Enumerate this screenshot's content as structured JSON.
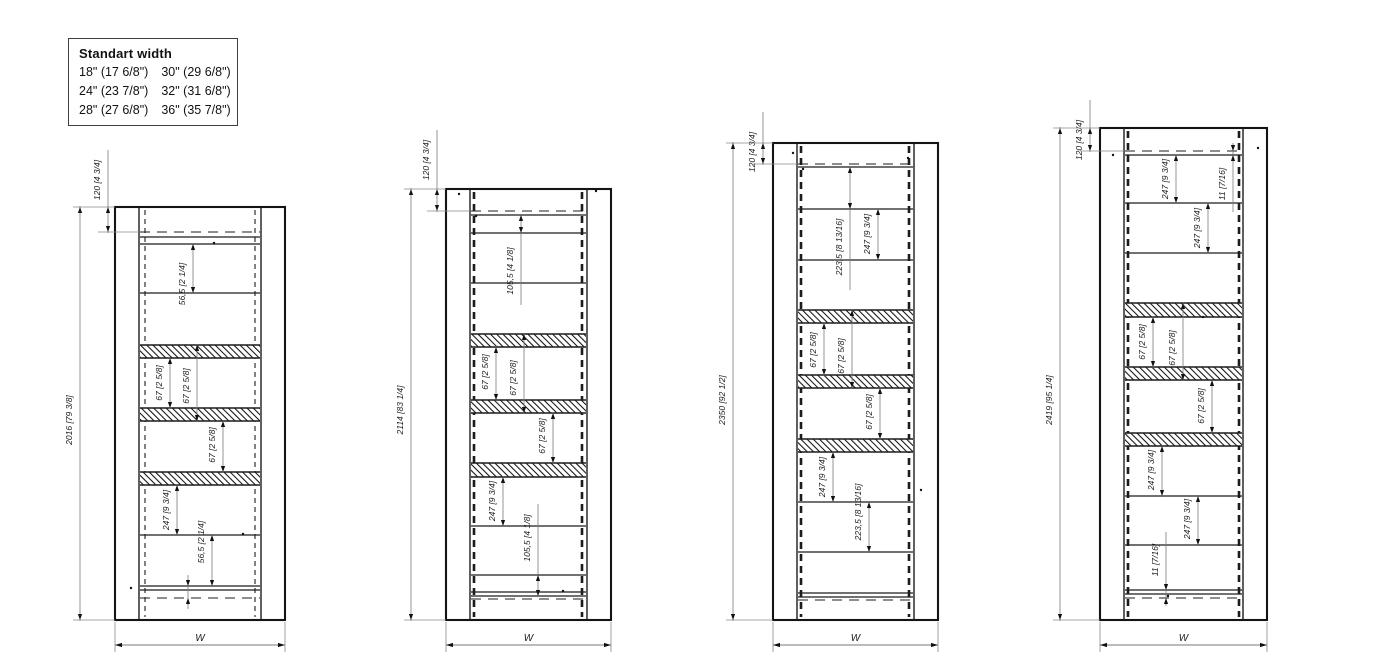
{
  "legend": {
    "title": "Standart width",
    "items": [
      "18\" (17 6/8\")",
      "24\" (23 7/8\")",
      "28\" (27 6/8\")",
      "30\" (29 6/8\")",
      "32\" (31 6/8\")",
      "36\" (35 7/8\")"
    ]
  },
  "drawing": {
    "colors": {
      "frame": "#141414",
      "line": "#1c1c1c",
      "hidden": "#1c1c1c",
      "dim_line": "#7a7a7a",
      "dim_text": "#1c1c1c",
      "arrow": "#111111"
    },
    "cabinets": [
      {
        "id": "elevation-2016",
        "outer": [
          115,
          207,
          170,
          413
        ],
        "wall": 24,
        "dash_x": [
          145,
          255
        ],
        "dash_style": "thin",
        "hlines": [
          [
            232,
            "d"
          ],
          [
            237,
            "s"
          ],
          [
            244,
            "s"
          ],
          [
            293,
            "s"
          ],
          [
            535,
            "s"
          ],
          [
            586,
            "s"
          ],
          [
            590,
            "s"
          ],
          [
            598,
            "d"
          ]
        ],
        "bands": [
          [
            345,
            358
          ],
          [
            408,
            421
          ],
          [
            472,
            485
          ]
        ],
        "vdims": [
          {
            "t": "120 [4 3/4]",
            "x": 108,
            "y1": 207,
            "y2": 232,
            "tx": 100,
            "ty": 180,
            "ly1": 150,
            "ext": [
              98,
              232,
              139
            ]
          },
          {
            "t": "2016 [79 3/8]",
            "x": 80,
            "y1": 207,
            "y2": 620,
            "tx": 72,
            "ty": 420,
            "cap": 1
          },
          {
            "t": "56,5 [2 1/4]",
            "x": 193,
            "y1": 244,
            "y2": 293,
            "tx": 185,
            "ty": 284
          },
          {
            "t": "67 [2 5/8]",
            "x": 170,
            "y1": 358,
            "y2": 408,
            "tx": 162,
            "ty": 383
          },
          {
            "t": "67 [2 5/8]",
            "x": 197,
            "y1": 345,
            "y2": 421,
            "tx": 189,
            "ty": 386
          },
          {
            "t": "67 [2 5/8]",
            "x": 223,
            "y1": 421,
            "y2": 472,
            "tx": 215,
            "ty": 445
          },
          {
            "t": "247 [9 3/4]",
            "x": 177,
            "y1": 485,
            "y2": 535,
            "tx": 169,
            "ty": 510
          },
          {
            "t": "56,5 [2 1/4]",
            "x": 212,
            "y1": 535,
            "y2": 586,
            "tx": 204,
            "ty": 542
          },
          {
            "t": "",
            "x": 188,
            "y1": 586,
            "y2": 598,
            "small": 1,
            "ly1": 575,
            "ly2": 609
          }
        ],
        "wdim": {
          "t": "W",
          "y": 645
        },
        "dots": [
          [
            214,
            243
          ],
          [
            131,
            588
          ],
          [
            243,
            534
          ]
        ]
      },
      {
        "id": "elevation-2114",
        "outer": [
          446,
          189,
          165,
          431
        ],
        "wall": 24,
        "dash_x": [
          474,
          582
        ],
        "dash_style": "bold",
        "hlines": [
          [
            211,
            "d"
          ],
          [
            215,
            "s"
          ],
          [
            233,
            "s"
          ],
          [
            283,
            "s"
          ],
          [
            526,
            "s"
          ],
          [
            575,
            "s"
          ],
          [
            592,
            "s"
          ],
          [
            596,
            "s"
          ],
          [
            599,
            "d"
          ]
        ],
        "bands": [
          [
            334,
            347
          ],
          [
            400,
            413
          ],
          [
            463,
            477
          ]
        ],
        "vdims": [
          {
            "t": "120 [4 3/4]",
            "x": 437,
            "y1": 189,
            "y2": 211,
            "tx": 429,
            "ty": 160,
            "ly1": 130,
            "ext": [
              427,
              211,
              470
            ]
          },
          {
            "t": "2114 [83 1/4]",
            "x": 411,
            "y1": 189,
            "y2": 620,
            "tx": 403,
            "ty": 410,
            "cap": 1
          },
          {
            "t": "105,5 [4 1/8]",
            "x": 521,
            "y1": 215,
            "y2": 233,
            "tx": 513,
            "ty": 271,
            "ly2": 305
          },
          {
            "t": "67 [2 5/8]",
            "x": 496,
            "y1": 347,
            "y2": 400,
            "tx": 488,
            "ty": 372
          },
          {
            "t": "67 [2 5/8]",
            "x": 524,
            "y1": 334,
            "y2": 413,
            "tx": 516,
            "ty": 378
          },
          {
            "t": "67 [2 5/8]",
            "x": 553,
            "y1": 413,
            "y2": 463,
            "tx": 545,
            "ty": 436
          },
          {
            "t": "247 [9 3/4]",
            "x": 503,
            "y1": 477,
            "y2": 526,
            "tx": 495,
            "ty": 501
          },
          {
            "t": "105,5 [4 1/8]",
            "x": 538,
            "y1": 575,
            "y2": 596,
            "tx": 530,
            "ty": 538,
            "ly1": 504
          }
        ],
        "wdim": {
          "t": "W",
          "y": 645
        },
        "dots": [
          [
            459,
            194
          ],
          [
            596,
            191
          ],
          [
            476,
            216
          ],
          [
            563,
            591
          ]
        ]
      },
      {
        "id": "elevation-2350",
        "outer": [
          773,
          143,
          165,
          477
        ],
        "wall": 24,
        "dash_x": [
          801,
          909
        ],
        "dash_style": "bold",
        "hlines": [
          [
            164,
            "d"
          ],
          [
            167,
            "s"
          ],
          [
            209,
            "s"
          ],
          [
            260,
            "s"
          ],
          [
            502,
            "s"
          ],
          [
            552,
            "s"
          ],
          [
            593,
            "s"
          ],
          [
            597,
            "s"
          ],
          [
            600,
            "d"
          ]
        ],
        "bands": [
          [
            310,
            323
          ],
          [
            375,
            388
          ],
          [
            439,
            452
          ]
        ],
        "vdims": [
          {
            "t": "120 [4 3/4]",
            "x": 763,
            "y1": 143,
            "y2": 164,
            "tx": 755,
            "ty": 152,
            "ly1": 112,
            "ext": [
              753,
              164,
              797
            ]
          },
          {
            "t": "2350 [92 1/2]",
            "x": 733,
            "y1": 143,
            "y2": 620,
            "tx": 725,
            "ty": 400,
            "cap": 1
          },
          {
            "t": "223,5 [8 13/16]",
            "x": 850,
            "y1": 167,
            "y2": 209,
            "tx": 842,
            "ty": 247,
            "ly2": 290
          },
          {
            "t": "247 [9 3/4]",
            "x": 878,
            "y1": 209,
            "y2": 260,
            "tx": 870,
            "ty": 234
          },
          {
            "t": "67 [2 5/8]",
            "x": 824,
            "y1": 323,
            "y2": 375,
            "tx": 816,
            "ty": 350
          },
          {
            "t": "67 [2 5/8]",
            "x": 852,
            "y1": 310,
            "y2": 388,
            "tx": 844,
            "ty": 356
          },
          {
            "t": "67 [2 5/8]",
            "x": 880,
            "y1": 388,
            "y2": 439,
            "tx": 872,
            "ty": 412
          },
          {
            "t": "247 [9 3/4]",
            "x": 833,
            "y1": 452,
            "y2": 502,
            "tx": 825,
            "ty": 477
          },
          {
            "t": "223,5 [8 13/16]",
            "x": 869,
            "y1": 502,
            "y2": 552,
            "tx": 861,
            "ty": 512
          }
        ],
        "wdim": {
          "t": "W",
          "y": 645
        },
        "dots": [
          [
            793,
            153
          ],
          [
            908,
            158
          ],
          [
            803,
            169
          ],
          [
            921,
            490
          ]
        ]
      },
      {
        "id": "elevation-2419",
        "outer": [
          1100,
          128,
          167,
          492
        ],
        "wall": 24,
        "dash_x": [
          1128,
          1239
        ],
        "dash_style": "bold",
        "hlines": [
          [
            151,
            "d"
          ],
          [
            155,
            "s"
          ],
          [
            203,
            "s"
          ],
          [
            253,
            "s"
          ],
          [
            496,
            "s"
          ],
          [
            545,
            "s"
          ],
          [
            590,
            "s"
          ],
          [
            594,
            "s"
          ],
          [
            598,
            "d"
          ]
        ],
        "bands": [
          [
            303,
            317
          ],
          [
            367,
            380
          ],
          [
            433,
            446
          ]
        ],
        "vdims": [
          {
            "t": "120 [4 3/4]",
            "x": 1090,
            "y1": 128,
            "y2": 151,
            "tx": 1082,
            "ty": 140,
            "ly1": 100,
            "ext": [
              1080,
              151,
              1124
            ]
          },
          {
            "t": "2419 [95 1/4]",
            "x": 1060,
            "y1": 128,
            "y2": 620,
            "tx": 1052,
            "ty": 400,
            "cap": 1
          },
          {
            "t": "247 [9 3/4]",
            "x": 1176,
            "y1": 155,
            "y2": 203,
            "tx": 1168,
            "ty": 179
          },
          {
            "t": "11 [7/16]",
            "x": 1233,
            "y1": 151,
            "y2": 155,
            "tx": 1225,
            "ty": 184,
            "small": 1,
            "ly1": 143,
            "ly2": 212
          },
          {
            "t": "247 [9 3/4]",
            "x": 1208,
            "y1": 203,
            "y2": 253,
            "tx": 1200,
            "ty": 228
          },
          {
            "t": "67 [2 5/8]",
            "x": 1153,
            "y1": 317,
            "y2": 367,
            "tx": 1145,
            "ty": 342
          },
          {
            "t": "67 [2 5/8]",
            "x": 1183,
            "y1": 303,
            "y2": 380,
            "tx": 1175,
            "ty": 348
          },
          {
            "t": "67 [2 5/8]",
            "x": 1212,
            "y1": 380,
            "y2": 433,
            "tx": 1204,
            "ty": 406
          },
          {
            "t": "247 [9 3/4]",
            "x": 1162,
            "y1": 446,
            "y2": 496,
            "tx": 1154,
            "ty": 470
          },
          {
            "t": "247 [9 3/4]",
            "x": 1198,
            "y1": 496,
            "y2": 545,
            "tx": 1190,
            "ty": 519
          },
          {
            "t": "11 [7/16]",
            "x": 1166,
            "y1": 590,
            "y2": 598,
            "tx": 1158,
            "ty": 560,
            "small": 1,
            "ly1": 532,
            "ly2": 606
          }
        ],
        "wdim": {
          "t": "W",
          "y": 645
        },
        "dots": [
          [
            1113,
            155
          ],
          [
            1258,
            148
          ],
          [
            1203,
            317
          ],
          [
            1168,
            596
          ]
        ]
      }
    ]
  }
}
